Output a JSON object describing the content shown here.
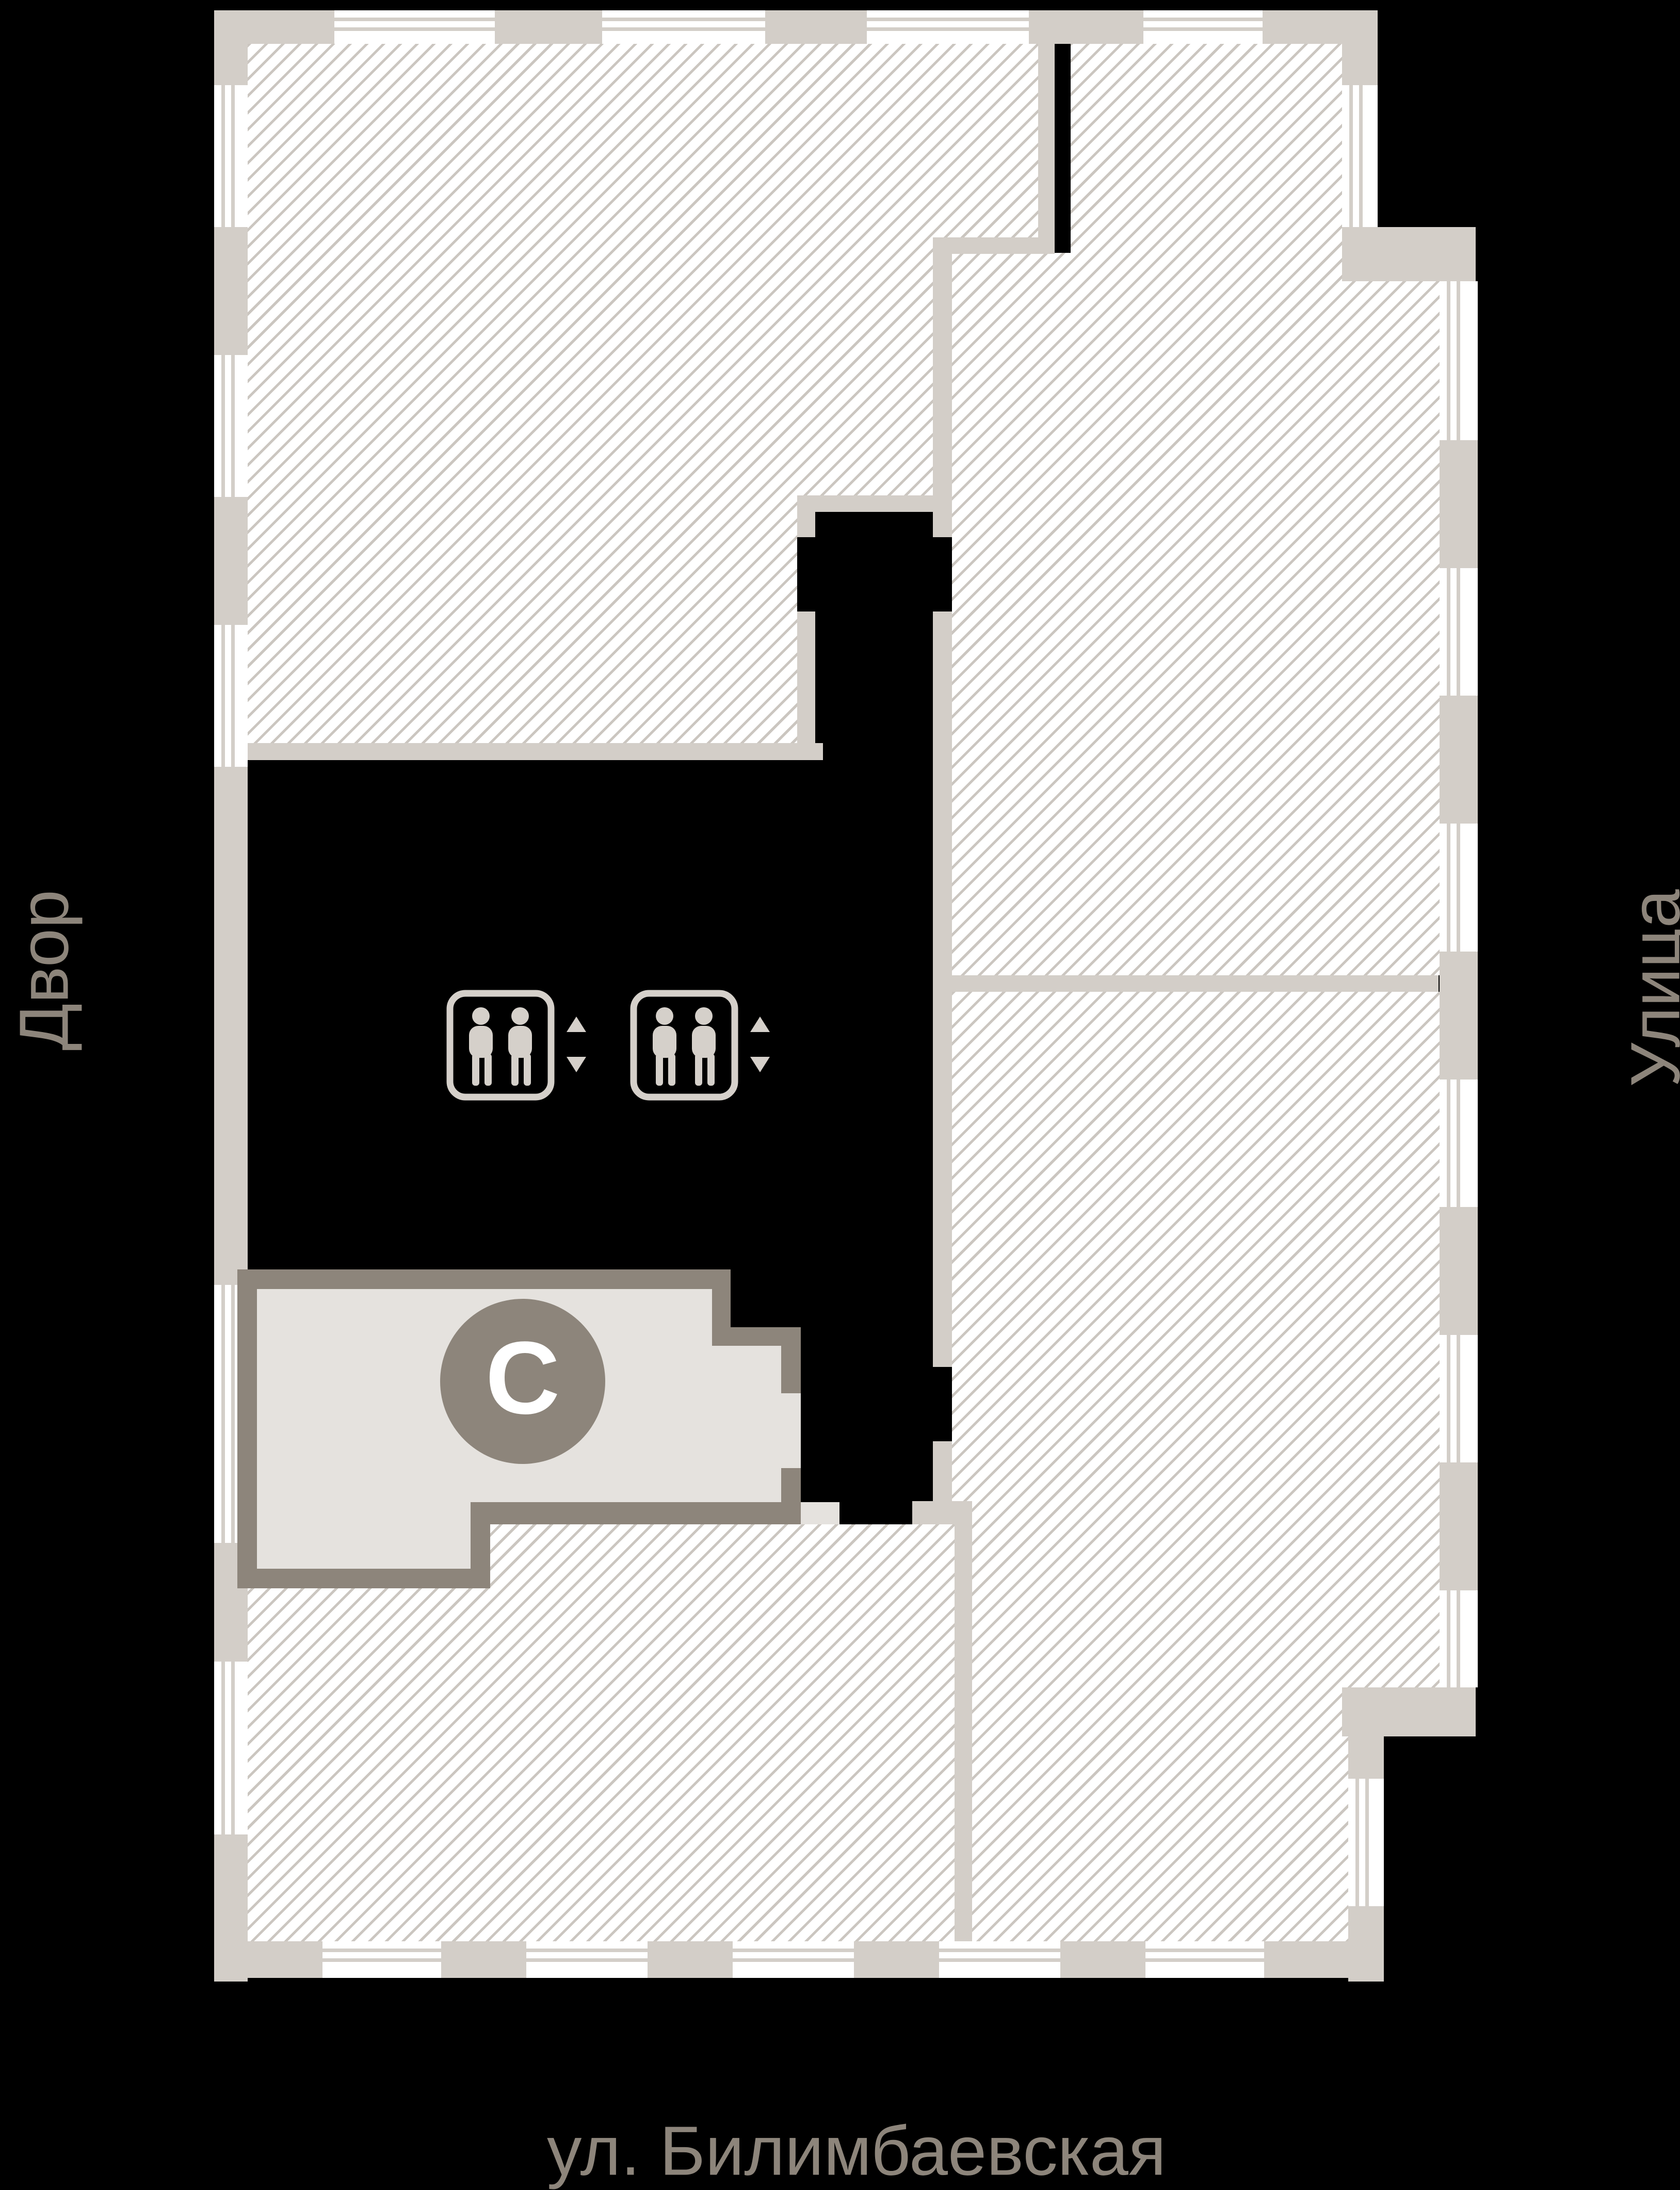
{
  "labels": {
    "left": "Двор",
    "right": "Улица",
    "street": "ул. Билимбаевская",
    "stairs": "С"
  },
  "icons": {
    "elevator": "elevator-icon",
    "arrow_up": "arrow-up-icon",
    "arrow_down": "arrow-down-icon",
    "stairs_badge": "stairs-badge"
  },
  "colors": {
    "background": "#000000",
    "wall": "#d3cec8",
    "hatch_line": "#cbc6c0",
    "stair_fill": "#e5e2de",
    "dark_accent": "#8d857b",
    "icon": "#d5d0ca",
    "label_text": "#8d857b",
    "stair_letter": "#ffffff"
  }
}
